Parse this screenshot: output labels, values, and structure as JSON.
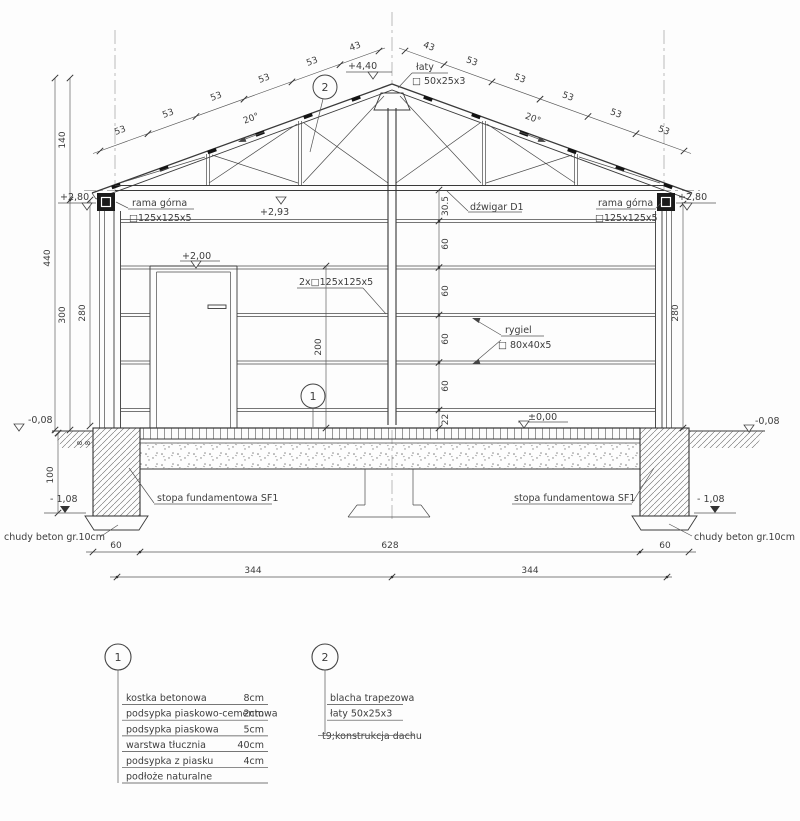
{
  "levels": {
    "ridge": "+4,40",
    "eave_left": "+2,80",
    "eave_right": "+2,80",
    "truss_bottom": "+2,93",
    "door_top": "+2,00",
    "floor": "±0,00",
    "ground_left": "-0,08",
    "ground_right": "-0,08",
    "footing_left": "- 1,08",
    "footing_right": "- 1,08"
  },
  "dims": {
    "d440": "440",
    "d300": "300",
    "d280": "280",
    "d140": "140",
    "d100": "100",
    "d200": "200",
    "d30_5": "30.5",
    "d60": "60",
    "d22": "22",
    "d8": "8",
    "d628": "628",
    "d344": "344",
    "d53": "53",
    "d43": "43",
    "angle": "20°"
  },
  "components": {
    "rama_gorna": "rama górna",
    "rama_gorna_profile": "□125x125x5",
    "laty": "łaty",
    "laty_profile": "□ 50x25x3",
    "dzwigar": "dźwigar D1",
    "column": "2x□125x125x5",
    "rygiel": "rygiel",
    "rygiel_profile": "□ 80x40x5",
    "stopa": "stopa fundamentowa SF1",
    "chudy": "chudy beton gr.10cm"
  },
  "markers": {
    "m1": "1",
    "m2": "2"
  },
  "legend1": {
    "number": "1",
    "rows": [
      {
        "label": "kostka betonowa",
        "value": "8cm"
      },
      {
        "label": "podsypka piaskowo-cementowa",
        "value": "2cm"
      },
      {
        "label": "podsypka piaskowa",
        "value": "5cm"
      },
      {
        "label": "warstwa tłucznia",
        "value": "40cm"
      },
      {
        "label": "podsypka z piasku",
        "value": "4cm"
      },
      {
        "label": "podłoże naturalne",
        "value": ""
      }
    ]
  },
  "legend2": {
    "number": "2",
    "rows": [
      "blacha trapezowa",
      "łaty 50x25x3",
      "t9;konstrukcja dachu"
    ]
  }
}
